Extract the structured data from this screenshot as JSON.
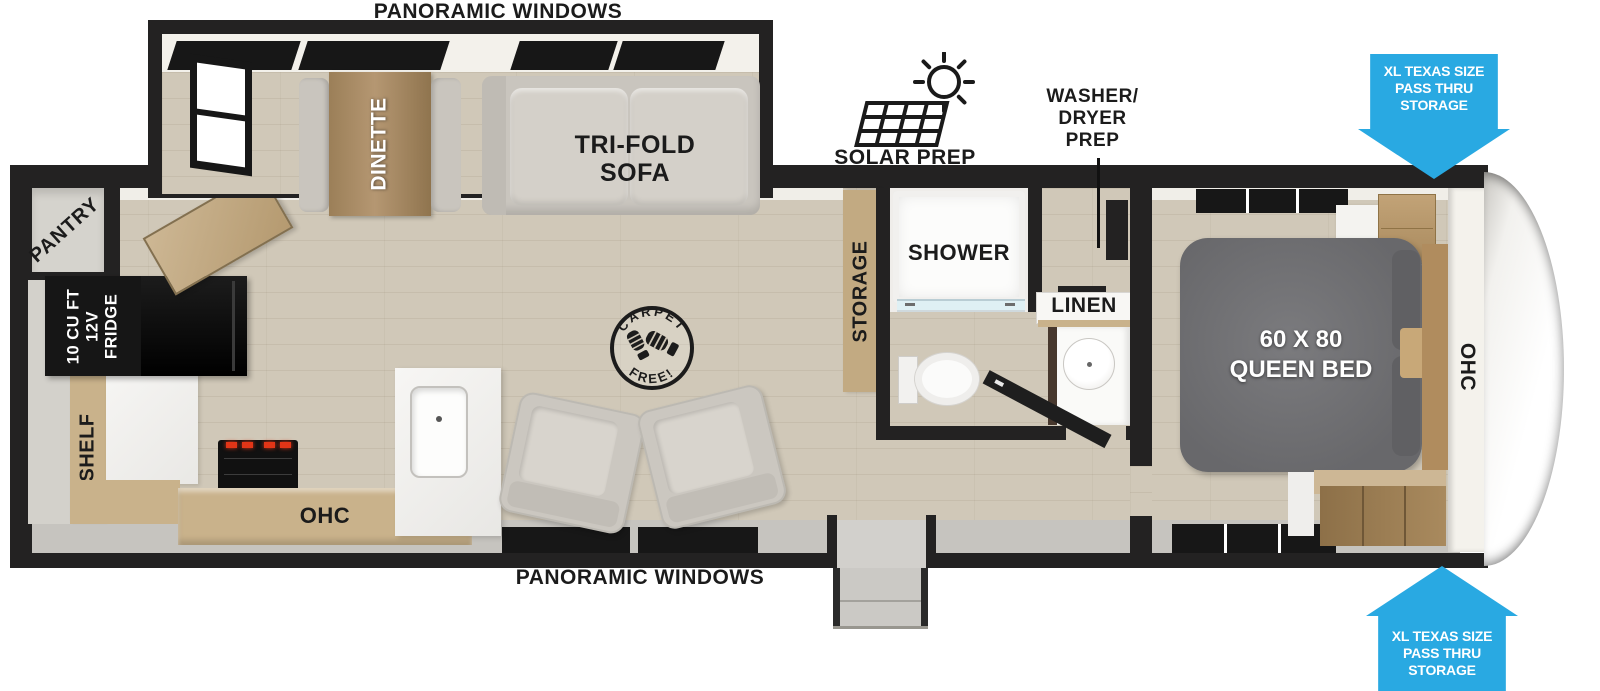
{
  "title": "Travel trailer floor plan",
  "colors": {
    "accent_blue": "#29A9E2",
    "wall": "#232222",
    "floor_wood": "#D0C8B8",
    "cabinet_tan": "#C9B28B",
    "table_wood": "#A5875E",
    "bed_gray": "#717174",
    "sofa_gray": "#C9C5BE"
  },
  "labels": {
    "panoramic_windows_top": "PANORAMIC WINDOWS",
    "panoramic_windows_bottom": "PANORAMIC WINDOWS",
    "solar_prep": "SOLAR PREP",
    "washer_dryer_prep": "WASHER/\nDRYER\nPREP",
    "pass_thru_storage_top": "XL TEXAS SIZE\nPASS THRU\nSTORAGE",
    "pass_thru_storage_bottom": "XL TEXAS SIZE\nPASS THRU\nSTORAGE",
    "pantry": "PANTRY",
    "fridge": "10 CU FT\n12V\nFRIDGE",
    "shelf": "SHELF",
    "ohc_kitchen": "OHC",
    "dinette": "DINETTE",
    "trifold_sofa": "TRI-FOLD\nSOFA",
    "storage": "STORAGE",
    "shower": "SHOWER",
    "linen": "LINEN",
    "queen_bed": "60 X 80\nQUEEN BED",
    "ohc_bedroom": "OHC",
    "carpet_top": "CARPET",
    "carpet_bottom": "FREE!"
  }
}
